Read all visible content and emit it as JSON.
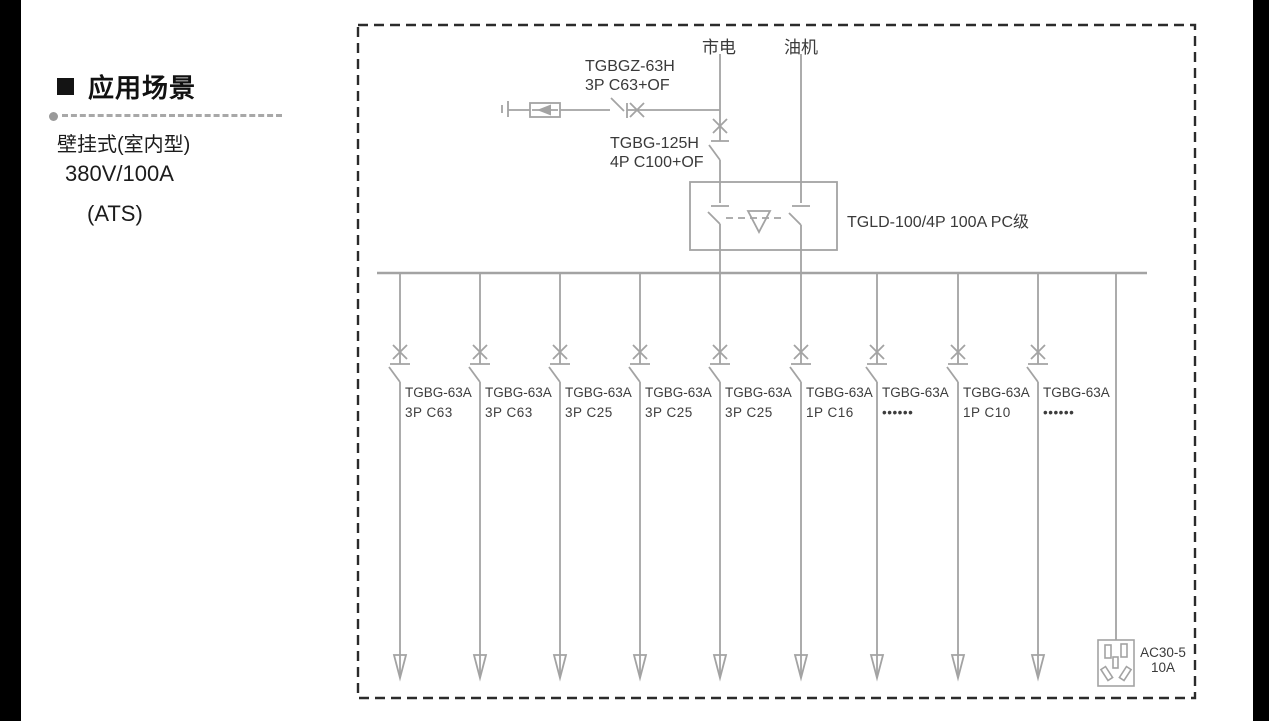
{
  "sidebar": {
    "title": "应用场景",
    "lines": [
      "壁挂式(室内型)",
      "380V/100A",
      "(ATS)"
    ]
  },
  "diagram": {
    "source_mains": "市电",
    "source_generator": "油机",
    "spd_breaker": {
      "line1": "TGBGZ-63H",
      "line2": "3P C63+OF"
    },
    "main_breaker": {
      "line1": "TGBG-125H",
      "line2": "4P C100+OF"
    },
    "ats_label": "TGLD-100/4P 100A PC级",
    "branches": [
      {
        "model": "TGBG-63A",
        "spec": "3P C63"
      },
      {
        "model": "TGBG-63A",
        "spec": "3P C63"
      },
      {
        "model": "TGBG-63A",
        "spec": "3P C25"
      },
      {
        "model": "TGBG-63A",
        "spec": "3P C25"
      },
      {
        "model": "TGBG-63A",
        "spec": "3P C25"
      },
      {
        "model": "TGBG-63A",
        "spec": "1P C16"
      },
      {
        "model": "TGBG-63A",
        "spec": "••••••"
      },
      {
        "model": "TGBG-63A",
        "spec": "1P C10"
      },
      {
        "model": "TGBG-63A",
        "spec": "••••••"
      }
    ],
    "socket": {
      "line1": "AC30-5",
      "line2": "10A"
    }
  },
  "colors": {
    "diagram_line": "#a3a3a3",
    "text": "#3a3a3a",
    "dashed_border": "#2b2b2b",
    "edge_bar": "#000000"
  }
}
